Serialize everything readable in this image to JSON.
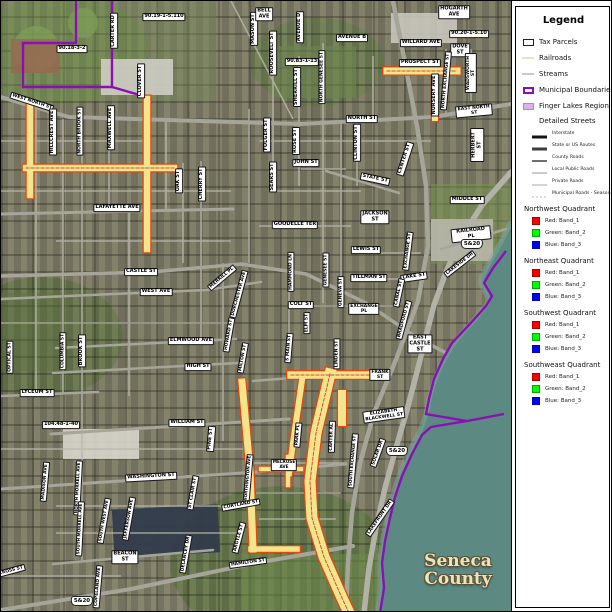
{
  "legend": {
    "title": "Legend",
    "items": [
      {
        "label": "Tax Parcels",
        "swatch": "rect",
        "stroke": "#222222",
        "fill": "#ffffff",
        "thick": 1
      },
      {
        "label": "Railroads",
        "swatch": "line",
        "stroke": "#e7e3c6",
        "fill": "",
        "thick": 2
      },
      {
        "label": "Streams",
        "swatch": "line",
        "stroke": "#c6cad6",
        "fill": "",
        "thick": 2
      },
      {
        "label": "Municipal Boundaries",
        "swatch": "rect",
        "stroke": "#8a10b5",
        "fill": "#ffffff",
        "thick": 2
      },
      {
        "label": "Finger Lakes Region",
        "swatch": "fill",
        "stroke": "#b87fd9",
        "fill": "#d9b3ef",
        "thick": 1
      }
    ],
    "detailed_streets": {
      "header": "Detailed Streets",
      "classes": [
        {
          "label": "Interstate",
          "color": "#141414",
          "weight": 3,
          "dash": ""
        },
        {
          "label": "State or US Routes",
          "color": "#3d3d3d",
          "weight": 3,
          "dash": ""
        },
        {
          "label": "County Roads",
          "color": "#6e6e6e",
          "weight": 2,
          "dash": ""
        },
        {
          "label": "Local Public Roads",
          "color": "#999999",
          "weight": 1,
          "dash": ""
        },
        {
          "label": "Private Roads",
          "color": "#ababab",
          "weight": 1,
          "dash": ""
        },
        {
          "label": "Municipal Roads - Seasonal",
          "color": "#b8b8b8",
          "weight": 1,
          "dash": "2,2"
        }
      ]
    },
    "quadrants": [
      {
        "header": "Northwest Quadrant",
        "bands": [
          {
            "label": "Red:   Band_1",
            "color": "#ff0000"
          },
          {
            "label": "Green: Band_2",
            "color": "#00ff00"
          },
          {
            "label": "Blue:  Band_3",
            "color": "#0000ff"
          }
        ]
      },
      {
        "header": "Northeast Quadrant",
        "bands": [
          {
            "label": "Red:   Band_1",
            "color": "#ff0000"
          },
          {
            "label": "Green: Band_2",
            "color": "#00ff00"
          },
          {
            "label": "Blue:  Band_3",
            "color": "#0000ff"
          }
        ]
      },
      {
        "header": "Southwest Quadrant",
        "bands": [
          {
            "label": "Red:   Band_1",
            "color": "#ff0000"
          },
          {
            "label": "Green: Band_2",
            "color": "#00ff00"
          },
          {
            "label": "Blue:  Band_3",
            "color": "#0000ff"
          }
        ]
      },
      {
        "header": "Southweast Quadrant",
        "bands": [
          {
            "label": "Red:   Band_1",
            "color": "#ff0000"
          },
          {
            "label": "Green: Band_2",
            "color": "#00ff00"
          },
          {
            "label": "Blue:  Band_3",
            "color": "#0000ff"
          }
        ]
      }
    ]
  },
  "map": {
    "county_label": {
      "line1": "Seneca",
      "line2": "County",
      "x": 457,
      "y": 570
    },
    "route_shields": [
      {
        "t": "5&20",
        "x": 471,
        "y": 243
      },
      {
        "t": "5&20",
        "x": 396,
        "y": 450
      },
      {
        "t": "5&20",
        "x": 81,
        "y": 600
      }
    ],
    "parcel_ids": [
      {
        "t": "90.19-1-5.110",
        "x": 163,
        "y": 16
      },
      {
        "t": "90.18-3-2",
        "x": 71,
        "y": 48
      },
      {
        "t": "90.20-1-5.10",
        "x": 468,
        "y": 33
      },
      {
        "t": "90.83-1-13",
        "x": 301,
        "y": 61
      },
      {
        "t": "104.48-1-40",
        "x": 60,
        "y": 424
      }
    ],
    "street_labels": [
      {
        "t": "CARTER RD",
        "x": 113,
        "y": 30,
        "r": -90
      },
      {
        "t": "MASON ST",
        "x": 253,
        "y": 28,
        "r": -90
      },
      {
        "t": "BELL\nAVE",
        "x": 263,
        "y": 13
      },
      {
        "t": "AVENUE D",
        "x": 299,
        "y": 26,
        "r": -90
      },
      {
        "t": "HOGARTH\nAVE",
        "x": 453,
        "y": 11
      },
      {
        "t": "AVENUE B",
        "x": 351,
        "y": 37
      },
      {
        "t": "WILLARD AVE",
        "x": 420,
        "y": 42
      },
      {
        "t": "DOVE\nST",
        "x": 459,
        "y": 49
      },
      {
        "t": "PROSPECT ST",
        "x": 419,
        "y": 62
      },
      {
        "t": "NURSERY AVE",
        "x": 434,
        "y": 94,
        "r": -90
      },
      {
        "t": "ROOSEVELT ST",
        "x": 272,
        "y": 52,
        "r": -90
      },
      {
        "t": "SHERRILL ST",
        "x": 296,
        "y": 86,
        "r": -90
      },
      {
        "t": "NORTH GENESEE ST",
        "x": 321,
        "y": 76,
        "r": -90,
        "fs": 4.5
      },
      {
        "t": "CLOVER ST",
        "x": 140,
        "y": 80,
        "r": -90
      },
      {
        "t": "WEST NORTH ST",
        "x": 31,
        "y": 101,
        "r": 18,
        "fs": 4.5
      },
      {
        "t": "NORTH ST",
        "x": 361,
        "y": 118
      },
      {
        "t": "EAST NORTH ST",
        "x": 473,
        "y": 110,
        "r": -5,
        "fs": 4.5
      },
      {
        "t": "NORTH EXCHANGE ST",
        "x": 445,
        "y": 80,
        "r": -85,
        "fs": 4.5
      },
      {
        "t": "WADSWORTH ST",
        "x": 470,
        "y": 72,
        "r": -90,
        "fs": 4.5
      },
      {
        "t": "HILLCREST AVE",
        "x": 52,
        "y": 131,
        "r": -90
      },
      {
        "t": "NORTH BROOK ST",
        "x": 79,
        "y": 130,
        "r": -90,
        "fs": 4.5
      },
      {
        "t": "MAXWELL AVE",
        "x": 110,
        "y": 127,
        "r": -90
      },
      {
        "t": "OAK ST",
        "x": 178,
        "y": 180,
        "r": -90
      },
      {
        "t": "CHERRY ST",
        "x": 201,
        "y": 183,
        "r": -90
      },
      {
        "t": "FOLGER ST",
        "x": 266,
        "y": 134,
        "r": -90
      },
      {
        "t": "ROSE ST",
        "x": 295,
        "y": 140,
        "r": -90
      },
      {
        "t": "CLINTON ST",
        "x": 356,
        "y": 142,
        "r": -90
      },
      {
        "t": "SEARS ST",
        "x": 272,
        "y": 176,
        "r": -90
      },
      {
        "t": "JOHN ST",
        "x": 305,
        "y": 162
      },
      {
        "t": "STATE ST",
        "x": 374,
        "y": 178,
        "r": 12
      },
      {
        "t": "CENTER ST",
        "x": 404,
        "y": 158,
        "r": -72
      },
      {
        "t": "HERBERT ST",
        "x": 476,
        "y": 144,
        "r": -90
      },
      {
        "t": "LAFAYETTE AVE",
        "x": 116,
        "y": 207
      },
      {
        "t": "MIDDLE ST",
        "x": 466,
        "y": 199
      },
      {
        "t": "JACKSON\nST",
        "x": 374,
        "y": 216
      },
      {
        "t": "RAILROAD PL",
        "x": 470,
        "y": 233,
        "r": -6
      },
      {
        "t": "GOODELLE TER",
        "x": 294,
        "y": 224
      },
      {
        "t": "LEWIS ST",
        "x": 365,
        "y": 249
      },
      {
        "t": "DORCHESTER AVE",
        "x": 238,
        "y": 293,
        "r": -75,
        "fs": 4.5
      },
      {
        "t": "MERRILL PL",
        "x": 221,
        "y": 277,
        "r": -40,
        "fs": 4.5
      },
      {
        "t": "TILLMAN ST",
        "x": 368,
        "y": 277
      },
      {
        "t": "LAKE ST",
        "x": 413,
        "y": 276,
        "r": -8
      },
      {
        "t": "LAKESIDE DR",
        "x": 459,
        "y": 263,
        "r": -38,
        "fs": 4.5
      },
      {
        "t": "CASTLE ST",
        "x": 140,
        "y": 271
      },
      {
        "t": "HAMMOND LN",
        "x": 290,
        "y": 271,
        "r": -90,
        "fs": 4.5
      },
      {
        "t": "GENESEE ST",
        "x": 325,
        "y": 269,
        "r": -90,
        "fs": 4.5
      },
      {
        "t": "GENEVA ST",
        "x": 340,
        "y": 291,
        "r": -90,
        "fs": 4.5
      },
      {
        "t": "CANAL ST",
        "x": 398,
        "y": 292,
        "r": -78,
        "fs": 4.5
      },
      {
        "t": "WEST AVE",
        "x": 155,
        "y": 291
      },
      {
        "t": "COLT ST",
        "x": 300,
        "y": 304
      },
      {
        "t": "EXCHANGE\nPL",
        "x": 363,
        "y": 308,
        "fs": 4.5
      },
      {
        "t": "ELM ST",
        "x": 306,
        "y": 322,
        "r": -90,
        "fs": 4.5
      },
      {
        "t": "BRADFORD ST",
        "x": 403,
        "y": 319,
        "r": -75,
        "fs": 4.5
      },
      {
        "t": "EAST\nCASTLE\nST",
        "x": 419,
        "y": 343
      },
      {
        "t": "EXCHANGE ST",
        "x": 407,
        "y": 250,
        "r": -83,
        "fs": 4.5
      },
      {
        "t": "LYCEUM ST",
        "x": 36,
        "y": 392
      },
      {
        "t": "OPTICAL ST",
        "x": 9,
        "y": 356,
        "r": -90,
        "fs": 4.5
      },
      {
        "t": "COLUMBIA ST",
        "x": 62,
        "y": 350,
        "r": -90,
        "fs": 4.5
      },
      {
        "t": "BROOK ST",
        "x": 81,
        "y": 350,
        "r": -90
      },
      {
        "t": "ELMWOOD AVE",
        "x": 190,
        "y": 340
      },
      {
        "t": "HOWARD ST",
        "x": 228,
        "y": 334,
        "r": -80,
        "fs": 4.5
      },
      {
        "t": "HIGH ST",
        "x": 197,
        "y": 366
      },
      {
        "t": "MILTON ST",
        "x": 242,
        "y": 357,
        "r": -80,
        "fs": 4.5
      },
      {
        "t": "S MAIN ST",
        "x": 288,
        "y": 347,
        "r": -85,
        "fs": 4.5
      },
      {
        "t": "LINDEN ST",
        "x": 336,
        "y": 353,
        "r": -90,
        "fs": 4.5
      },
      {
        "t": "WILLIAM ST",
        "x": 186,
        "y": 422
      },
      {
        "t": "PINE ST",
        "x": 210,
        "y": 438,
        "r": -85
      },
      {
        "t": "FRANK\nST",
        "x": 379,
        "y": 374,
        "fs": 4.5
      },
      {
        "t": "WASHINGTON ST",
        "x": 150,
        "y": 476,
        "r": -3
      },
      {
        "t": "MADISON AVE",
        "x": 44,
        "y": 481,
        "r": -85,
        "fs": 4.5
      },
      {
        "t": "NORTH MORRELL AVE",
        "x": 77,
        "y": 487,
        "r": -87,
        "fs": 4.2
      },
      {
        "t": "SOUTH MORRELL AVE",
        "x": 79,
        "y": 528,
        "r": -87,
        "fs": 4.2
      },
      {
        "t": "SOUTH WEST AVE",
        "x": 103,
        "y": 520,
        "r": -80,
        "fs": 4.2
      },
      {
        "t": "JEFFERSON AVE",
        "x": 128,
        "y": 518,
        "r": -80,
        "fs": 4.5
      },
      {
        "t": "ST CLAIR ST",
        "x": 192,
        "y": 492,
        "r": -80,
        "fs": 4.5
      },
      {
        "t": "WORTHINGTON AVE",
        "x": 247,
        "y": 478,
        "r": -85,
        "fs": 4.2
      },
      {
        "t": "CORTLAND ST",
        "x": 240,
        "y": 504,
        "r": -10,
        "fs": 4.5
      },
      {
        "t": "ARGYLE ST",
        "x": 238,
        "y": 537,
        "r": -75,
        "fs": 4.5
      },
      {
        "t": "DELANCEY DR",
        "x": 185,
        "y": 553,
        "r": -80,
        "fs": 4.5
      },
      {
        "t": "BEACON\nST",
        "x": 124,
        "y": 556
      },
      {
        "t": "COPELAND AVE",
        "x": 97,
        "y": 586,
        "r": -85,
        "fs": 4.5
      },
      {
        "t": "CROSS ST",
        "x": 10,
        "y": 570,
        "r": -15,
        "fs": 4.5
      },
      {
        "t": "MELROSE\nAVE",
        "x": 283,
        "y": 464,
        "fs": 4.2
      },
      {
        "t": "PARK PL",
        "x": 297,
        "y": 434,
        "r": -85,
        "fs": 4.5
      },
      {
        "t": "CARTER AL",
        "x": 331,
        "y": 436,
        "r": -88,
        "fs": 4.5
      },
      {
        "t": "SOUTH EXCHANGE ST",
        "x": 352,
        "y": 460,
        "r": -85,
        "fs": 4.2
      },
      {
        "t": "SOLAR DR",
        "x": 377,
        "y": 452,
        "r": -70,
        "fs": 4.5
      },
      {
        "t": "ELIZABETH\nBLACKWELL ST",
        "x": 383,
        "y": 414,
        "r": -8,
        "fs": 4.5
      },
      {
        "t": "LAKEFRONT DR",
        "x": 379,
        "y": 517,
        "r": -55,
        "fs": 4.5
      },
      {
        "t": "HAMILTON ST",
        "x": 247,
        "y": 562,
        "r": -8,
        "fs": 4.5
      }
    ]
  }
}
